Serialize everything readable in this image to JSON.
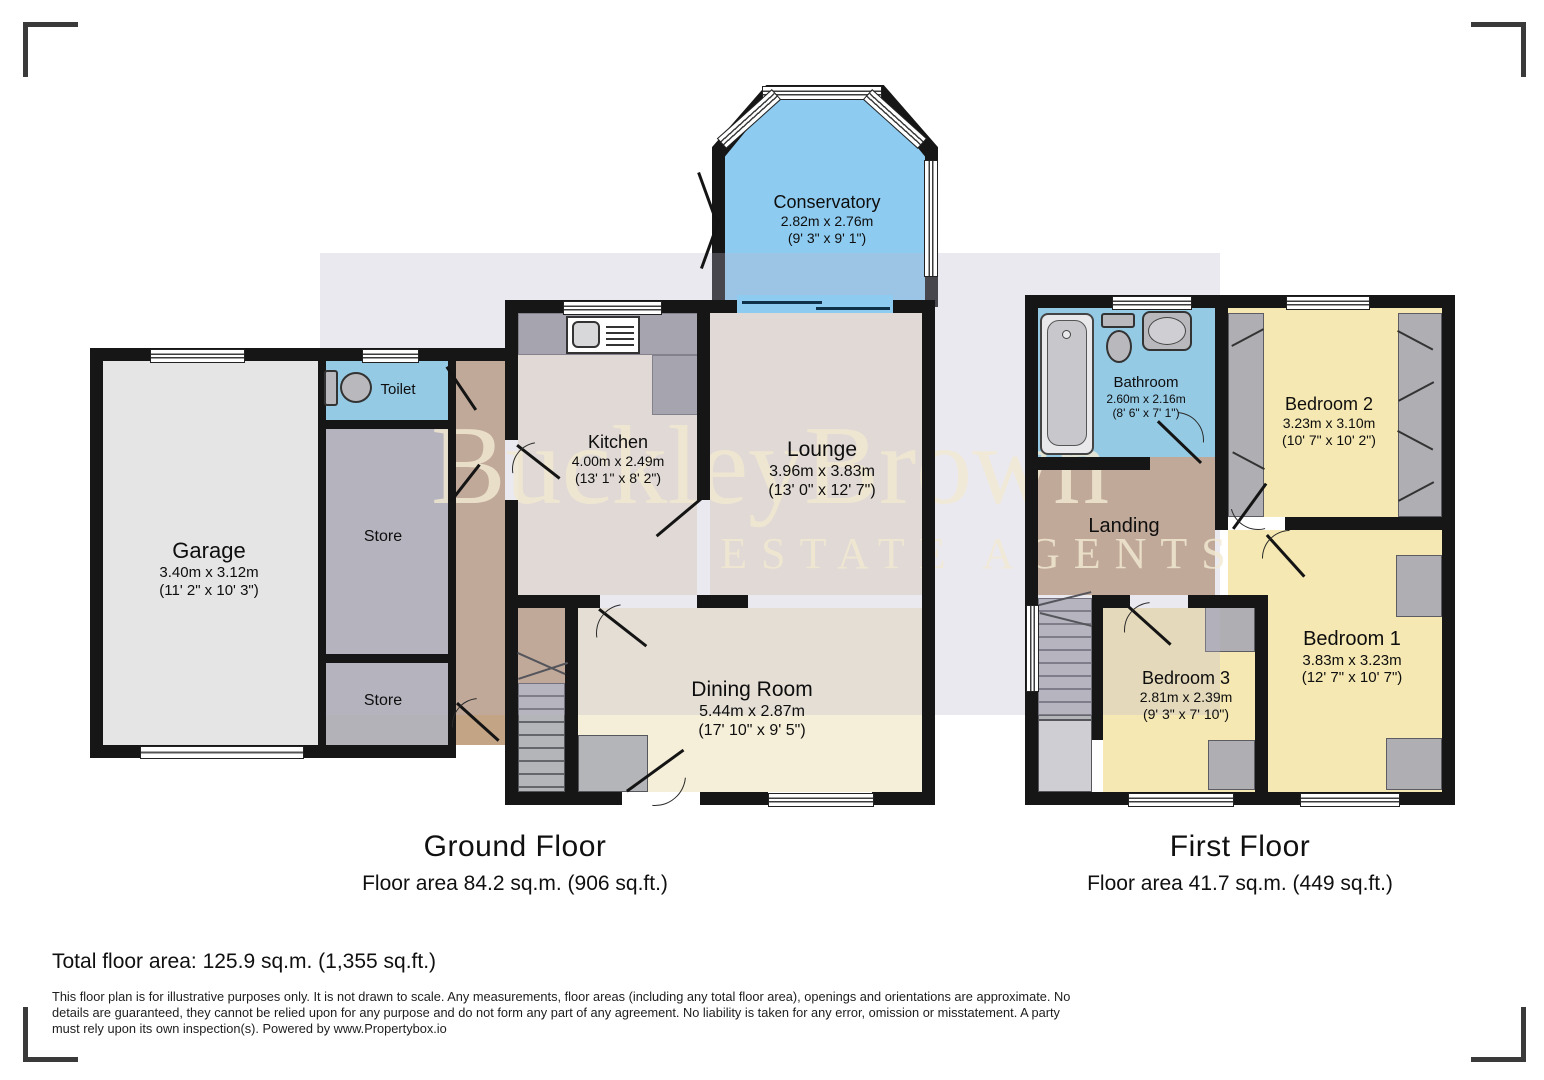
{
  "watermark": {
    "line1": "BuckleyBrown",
    "line2": "ESTATE AGENTS"
  },
  "floors": [
    {
      "title": "Ground Floor",
      "area": "Floor area 84.2 sq.m. (906 sq.ft.)",
      "rooms": [
        {
          "name": "Garage",
          "metric": "3.40m x 3.12m",
          "imperial": "(11' 2\" x 10' 3\")"
        },
        {
          "name": "Toilet"
        },
        {
          "name": "Store"
        },
        {
          "name": "Store"
        },
        {
          "name": "Kitchen",
          "metric": "4.00m x 2.49m",
          "imperial": "(13' 1\" x 8' 2\")"
        },
        {
          "name": "Lounge",
          "metric": "3.96m x 3.83m",
          "imperial": "(13' 0\" x 12' 7\")"
        },
        {
          "name": "Dining Room",
          "metric": "5.44m x 2.87m",
          "imperial": "(17' 10\" x 9' 5\")"
        },
        {
          "name": "Conservatory",
          "metric": "2.82m x 2.76m",
          "imperial": "(9' 3\" x 9' 1\")"
        }
      ]
    },
    {
      "title": "First Floor",
      "area": "Floor area 41.7 sq.m. (449 sq.ft.)",
      "rooms": [
        {
          "name": "Bathroom",
          "metric": "2.60m x 2.16m",
          "imperial": "(8' 6\" x 7' 1\")"
        },
        {
          "name": "Landing"
        },
        {
          "name": "Bedroom 2",
          "metric": "3.23m x 3.10m",
          "imperial": "(10' 7\" x 10' 2\")"
        },
        {
          "name": "Bedroom 1",
          "metric": "3.83m x 3.23m",
          "imperial": "(12' 7\" x 10' 7\")"
        },
        {
          "name": "Bedroom 3",
          "metric": "2.81m x 2.39m",
          "imperial": "(9' 3\" x 7' 10\")"
        }
      ]
    }
  ],
  "footer": {
    "total": "Total floor area: 125.9 sq.m. (1,355 sq.ft.)",
    "disclaimer": "This floor plan is for illustrative purposes only. It is not drawn to scale. Any measurements, floor areas (including any total floor area), openings and orientations are approximate. No details are guaranteed, they cannot be relied upon for any purpose and do not form any part of any agreement. No liability is taken for any error, omission or misstatement. A party must rely upon its own inspection(s). Powered by www.Propertybox.io"
  },
  "colors": {
    "wall": "#161616",
    "water_blue": "#85d3f0",
    "conservatory_blue": "#8ecbf0",
    "bedroom_yellow": "#f5e8b2",
    "cream_floor": "#efe8d9",
    "dining_cream": "#f5efd9",
    "hall_brown": "#c3a485",
    "store_gray": "#b2b2b8",
    "garage_gray": "#e5e5e5",
    "fixture_gray": "#9b9ca2",
    "watermark_tint": "#dcd8e6",
    "watermark_text": "#f2e9d1"
  }
}
